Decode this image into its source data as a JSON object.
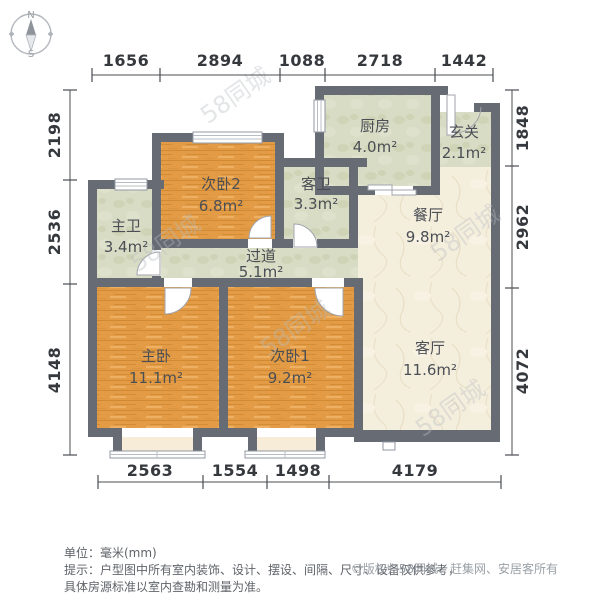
{
  "compass": {
    "north": "N",
    "south": "S"
  },
  "dimensions": {
    "unit": "mm",
    "top": [
      "1656",
      "2894",
      "1088",
      "2718",
      "1442"
    ],
    "left": [
      "2198",
      "2536",
      "4148"
    ],
    "right": [
      "1848",
      "2962",
      "4072"
    ],
    "bottom": [
      "2563",
      "1554",
      "1498",
      "4179"
    ]
  },
  "rooms": {
    "kitchen": {
      "name": "厨房",
      "area": "4.0m²"
    },
    "entry": {
      "name": "玄关",
      "area": "2.1m²"
    },
    "bedroom2": {
      "name": "次卧2",
      "area": "6.8m²"
    },
    "guest_bath": {
      "name": "客卫",
      "area": "3.3m²"
    },
    "master_bath": {
      "name": "主卫",
      "area": "3.4m²"
    },
    "dining": {
      "name": "餐厅",
      "area": "9.8m²"
    },
    "hallway": {
      "name": "过道",
      "area": "5.1m²"
    },
    "master_bedroom": {
      "name": "主卧",
      "area": "11.1m²"
    },
    "bedroom1": {
      "name": "次卧1",
      "area": "9.2m²"
    },
    "living": {
      "name": "客厅",
      "area": "11.6m²"
    }
  },
  "watermark": {
    "text": "58同城"
  },
  "footer": {
    "unit_label": "单位：毫米(mm)",
    "tip_line1": "提示：户型图中所有室内装饰、设计、摆设、间隔、尺寸、设备仅供参考，",
    "tip_line2": "具体房源标准以室内查勘和测量为准。",
    "copyright": "©版权归58同城、赶集网、安居客所有"
  },
  "colors": {
    "wall": "#676b74",
    "wood": "#e39c45",
    "tile": "#d9dcc4",
    "marble": "#f4eedd",
    "bay": "#f6ecd7",
    "dim_line": "#4a4d52",
    "dim_text": "#35383d",
    "room_text": "#4b4f55",
    "footer_text": "#5f6368",
    "copyright_text": "#9aa0a6",
    "watermark": "#b9bdc2"
  }
}
